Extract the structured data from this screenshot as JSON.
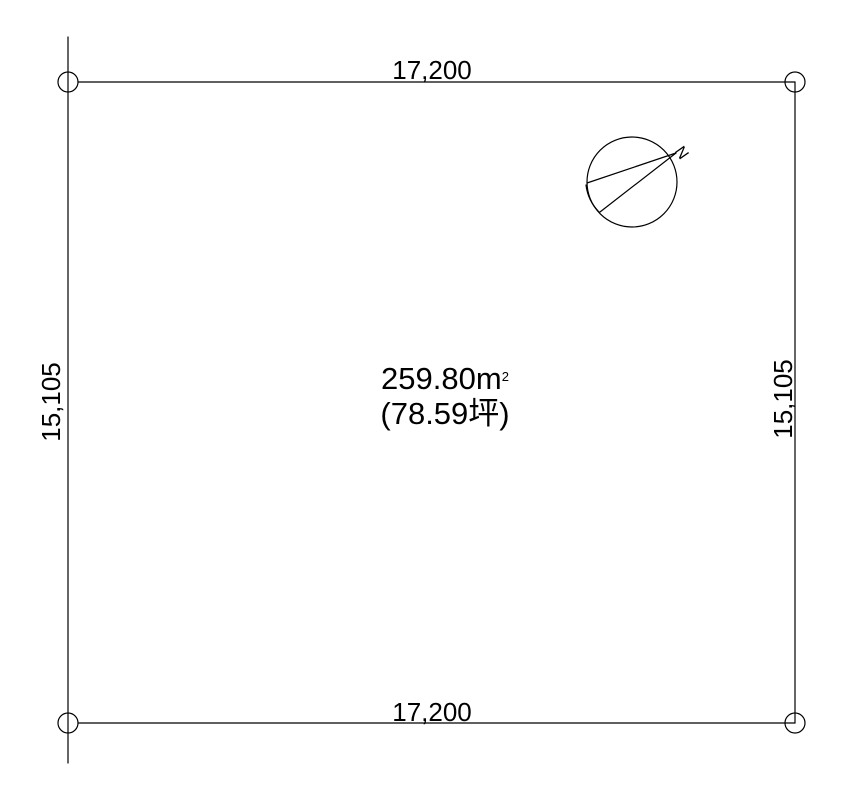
{
  "drawing": {
    "background_color": "#ffffff",
    "line_color": "#000000",
    "text_color": "#000000"
  },
  "dimensions": {
    "top": "17,200",
    "bottom": "17,200",
    "left": "15,105",
    "right": "15,105"
  },
  "area": {
    "square_meters": "259.80",
    "unit": "m",
    "superscript": "2",
    "tsubo": "(78.59坪)"
  },
  "compass": {
    "north_label": "N"
  }
}
